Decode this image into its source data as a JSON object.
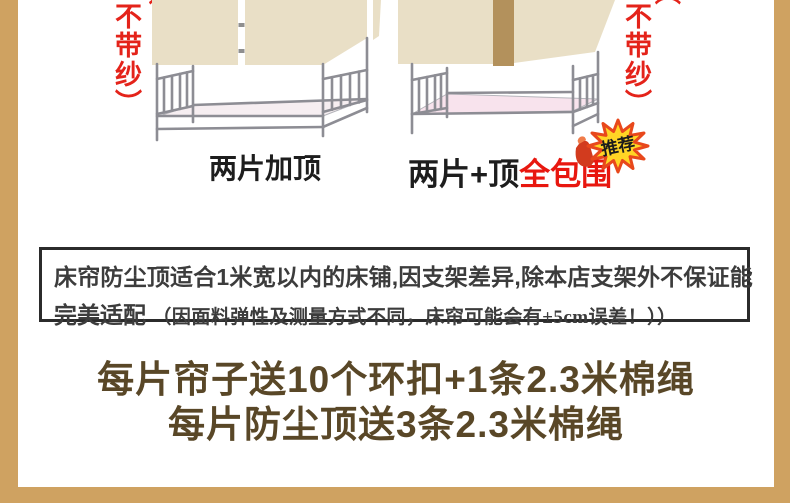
{
  "top_section": {
    "left_variant": {
      "side_note_open_paren": "（",
      "side_note": "不带纱）",
      "label": "两片加顶"
    },
    "right_variant": {
      "side_note_open_paren": "（",
      "side_note": "不带纱）",
      "label_black": "两片+顶",
      "label_red": "全包围",
      "badge_label": "推荐"
    }
  },
  "notice_box": {
    "line1": "床帘防尘顶适合1米宽以内的床铺,因支架差异,除本店支架外不保证能",
    "line2_bold": "完美适配",
    "line2_note": "（因面料弹性及测量方式不同，床帘可能会有±5cm误差！））"
  },
  "gift_block": {
    "line1": "每片帘子送10个环扣+1条2.3米棉绳",
    "line2": "每片防尘顶送3条2.3米棉绳"
  },
  "colors": {
    "frame_strip": "#cfa261",
    "curtain_beige": "#e9dfc6",
    "curtain_top_strip": "#b3915c",
    "bed_frame_gray": "#8d8d94",
    "mattress_left": "#f6eef1",
    "mattress_right": "#f8e3ed",
    "side_note_red": "#e4231a",
    "label_red": "#e8170f",
    "badge_yellow": "#ffd525",
    "badge_spike_red": "#e8481c",
    "gift_text_brown": "#594727"
  }
}
